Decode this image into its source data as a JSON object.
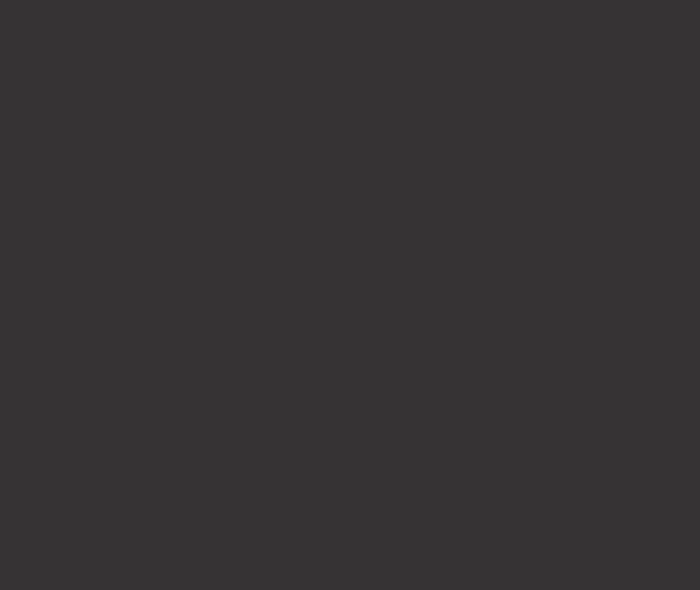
{
  "screen": {
    "description": "blank-dark-screen",
    "background_color": "#363334"
  }
}
